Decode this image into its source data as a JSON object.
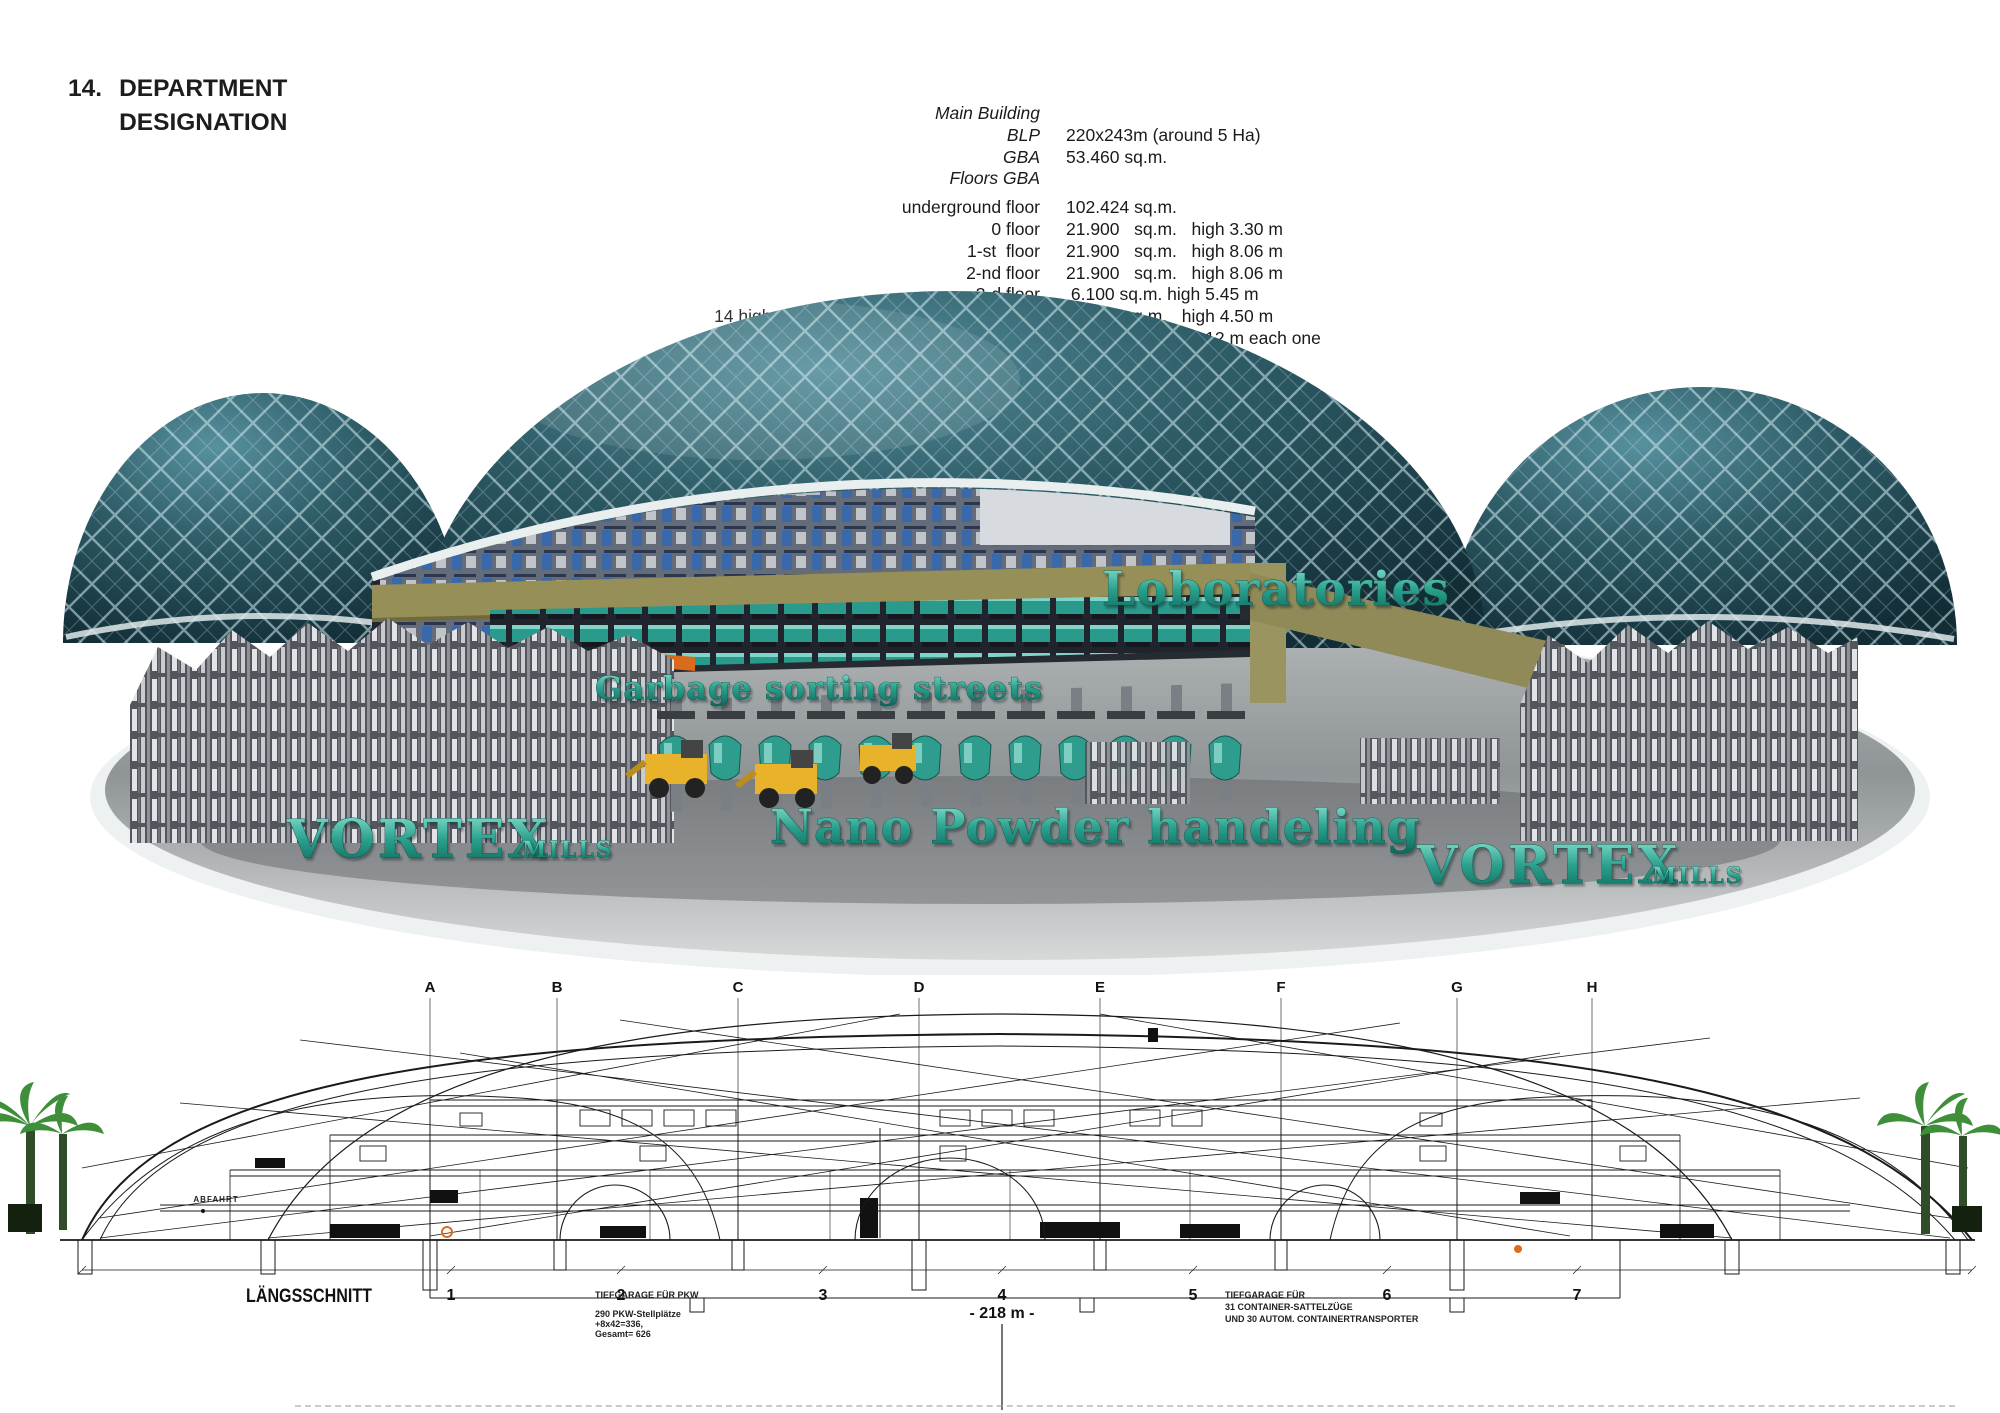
{
  "page": {
    "heading_number": "14.",
    "heading_line1": "DEPARTMENT",
    "heading_line2": "DESIGNATION"
  },
  "specs": {
    "rows": [
      {
        "label": "Main Building",
        "value": ""
      },
      {
        "label": "BLP",
        "value": "220x243m (around 5 Ha)"
      },
      {
        "label": "GBA",
        "value": "53.460 sq.m."
      },
      {
        "label": "Floors GBA",
        "value": ""
      },
      {
        "label": "underground floor",
        "value": "102.424 sq.m."
      },
      {
        "label": "0 floor",
        "value": "21.900   sq.m.   high 3.30 m"
      },
      {
        "label": "1-st  floor",
        "value": "21.900   sq.m.   high 8.06 m"
      },
      {
        "label": "2-nd floor",
        "value": "21.900   sq.m.   high 8.06 m"
      },
      {
        "label": "3-d floor",
        "value": " 6.100 sq.m. high 5.45 m"
      },
      {
        "label": "14 high secured and sealed Nano Powder",
        "value": "4.788   sq.m.   high 4.50 m"
      },
      {
        "label": "Processing",
        "label_em": "arms",
        "value": " 1.846 sq.m. high 12 m each one"
      },
      {
        "label": "",
        "value": "25.844 sq.m. totally"
      }
    ]
  },
  "dome_labels": {
    "laboratories": "Loboratories",
    "garbage": "Garbage sorting streets",
    "nano": "Nano Powder handeling",
    "vortex_left": "VORTEX",
    "vortex_left_sub": "MILLS",
    "vortex_right": "VORTEX",
    "vortex_right_sub": "MILLS"
  },
  "section": {
    "title": "LÄNGSSCHNITT",
    "grid_letters": [
      "A",
      "B",
      "C",
      "D",
      "E",
      "F",
      "G",
      "H"
    ],
    "grid_numbers": [
      "1",
      "2",
      "3",
      "4",
      "5",
      "6",
      "7"
    ],
    "dimension": "- 218 m -",
    "abfahrt": "ABFAHRT",
    "note_left": [
      "TIEFGARAGE FÜR PKW",
      "290 PKW-Stellplätze",
      "+8x42=336,",
      "Gesamt= 626"
    ],
    "note_right": [
      "TIEFGARAGE FÜR",
      "31 CONTAINER-SATTELZÜGE",
      "UND 30 AUTOM. CONTAINERTRANSPORTER"
    ]
  },
  "colors": {
    "dome_teal": "#2d5b66",
    "mesh_line": "#cfe9ee",
    "label_teal": "#1d8a7a",
    "khaki_deck": "#938e58",
    "orange_accent": "#d96a1e",
    "palm_green": "#3f8f3a",
    "platform_grey": "#9a9ea0",
    "ink": "#1b1b1b"
  }
}
